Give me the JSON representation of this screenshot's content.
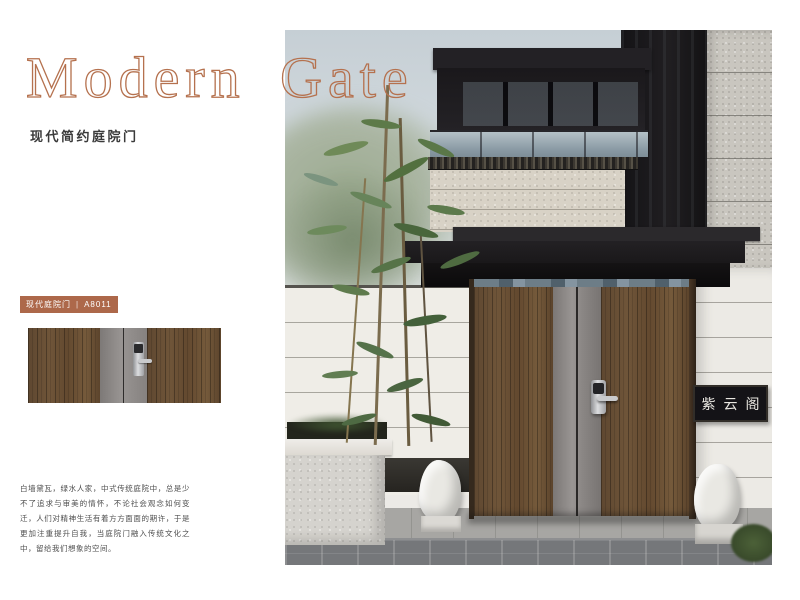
{
  "page": {
    "title": "Modern Gate",
    "subtitle": "现代简约庭院门",
    "accent_color": "#b5714e",
    "background": "#ffffff"
  },
  "badge": {
    "category": "现代庭院门",
    "divider": "|",
    "model": "A8011",
    "bg_color": "#ad684a",
    "text_color": "#ffffff"
  },
  "left_panel": {
    "description": "白墙黛瓦，绿水人家，中式传统庭院中，总是少不了追求与审美的情怀，不论社会观念如何变迁，人们对精神生活有着方方面面的期许，于是更加注重提升自我，当庭院门融入传统文化之中，留给我们想象的空间。"
  },
  "thumbnail": {
    "label": "gate-product-front-view",
    "wood_color": "#6b5236",
    "panel_color": "#8d8886"
  },
  "photo": {
    "signboard": "紫云阁",
    "colors": {
      "sky": "#cdd5da",
      "canopy": "#1d1b1d",
      "gate_wood": "#6a5135",
      "gate_stile": "#8d8886",
      "wall": "#efede7",
      "pavement_dark": "#75777a",
      "bamboo_green": "#57703f"
    }
  }
}
